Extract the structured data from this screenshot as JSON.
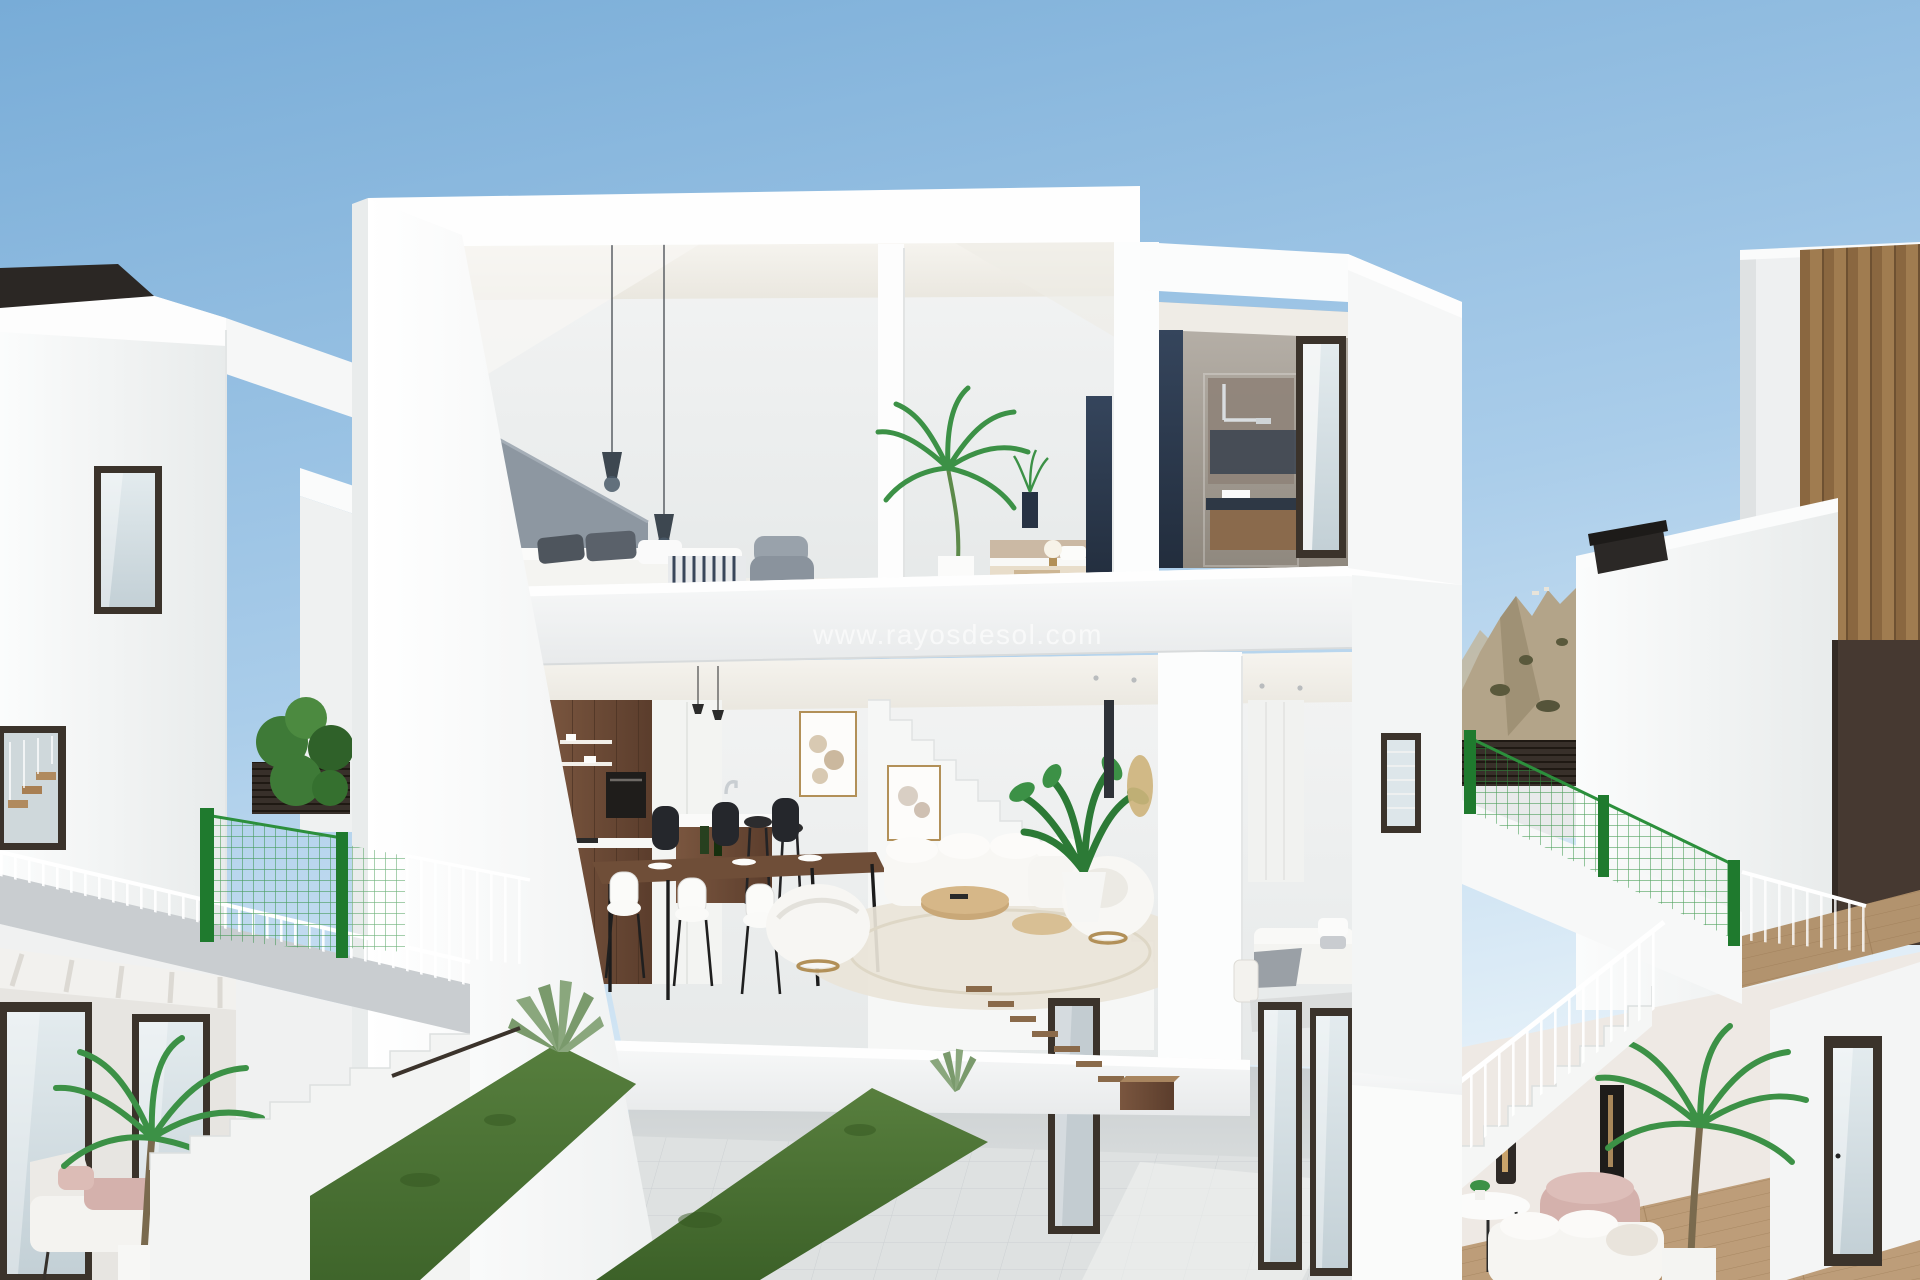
{
  "image": {
    "width": 1920,
    "height": 1280
  },
  "scene": {
    "type": "3d-architectural-cutaway-render",
    "subject": "Cross-section render of a three-storey modern white villa between neighbouring houses",
    "floors": [
      "top-floor-two-bedrooms-and-bathroom",
      "middle-floor-kitchen-dining-living-bedroom",
      "basement-with-floating-stairs"
    ],
    "exterior": [
      "left-neighbour-house",
      "right-neighbour-house",
      "green-mesh-fences",
      "white-exterior-stairs",
      "gardens-with-palms",
      "mountain-view"
    ]
  },
  "watermark": {
    "text": "www.rayosdesol.com"
  },
  "palette": {
    "sky_top": "#78acd7",
    "sky_mid": "#aacdea",
    "sky_low": "#e7f2f9",
    "white": "#ffffff",
    "wall_shadow": "#dfe3e4",
    "green_fence": "#2c8f3c",
    "green_fence_dark": "#1f7a2e",
    "grass": "#4e7b3a",
    "plant_green": "#3c9146",
    "walnut_wood": "#6b4a36",
    "light_wood": "#c7a97e",
    "deck_wood": "#b2936e",
    "mountain_tan": "#b3a489",
    "dark_fence": "#38302a",
    "dark_brown_wall": "#463931",
    "window_frame": "#3b332b",
    "glass_blue": "#ccd9de",
    "headboard_gray": "#8d97a1",
    "navy_panel": "#2c3a4e",
    "stone_taupe": "#a39d94",
    "gold_accent": "#b29058",
    "blush_pink": "#d4b1ac",
    "tile_gray": "#dee1e1",
    "watermark_color": "#fafafa"
  }
}
